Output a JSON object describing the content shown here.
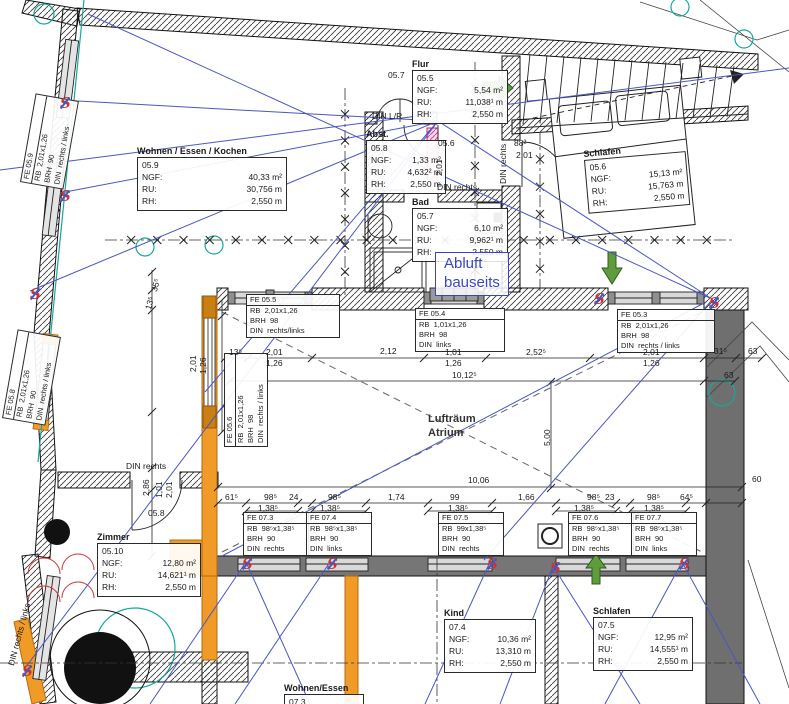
{
  "labels": {
    "ngf": "NGF:",
    "ru": "RU:",
    "rh": "RH:"
  },
  "rooms": [
    {
      "name": "Wohnen / Essen / Kochen",
      "id": "05.9",
      "ngf": "40,33 m²",
      "ru": "30,756 m",
      "rh": "2,550 m",
      "x": 137,
      "y": 146,
      "w": 140,
      "rot": 0
    },
    {
      "name": "Flur",
      "id": "05.5",
      "ngf": "5,54 m²",
      "ru": "11,038¹ m",
      "rh": "2,550 m",
      "x": 412,
      "y": 59,
      "w": 86,
      "rot": 0
    },
    {
      "name": "Abst.",
      "id": "05.8",
      "ngf": "1,33 m²",
      "ru": "4,632² m",
      "rh": "2,550 m",
      "x": 366,
      "y": 129,
      "w": 70,
      "rot": 0
    },
    {
      "name": "Bad",
      "id": "05.7",
      "ngf": "6,10 m²",
      "ru": "9,962¹ m",
      "rh": "2,550 m",
      "x": 412,
      "y": 197,
      "w": 86,
      "rot": 0
    },
    {
      "name": "Schlafen",
      "id": "05.6",
      "ngf": "15,13 m²",
      "ru": "15,763 m",
      "rh": "2,550 m",
      "x": 583,
      "y": 149,
      "w": 92,
      "rot": -5
    },
    {
      "name": "Zimmer",
      "id": "05.10",
      "ngf": "12,80 m²",
      "ru": "14,621¹ m",
      "rh": "2,550 m",
      "x": 97,
      "y": 532,
      "w": 94,
      "rot": 0
    },
    {
      "name": "Kind",
      "id": "07.4",
      "ngf": "10,36 m²",
      "ru": "13,310 m",
      "rh": "2,550 m",
      "x": 444,
      "y": 608,
      "w": 82,
      "rot": 0
    },
    {
      "name": "Schlafen",
      "id": "07.5",
      "ngf": "12,95 m²",
      "ru": "14,555¹ m",
      "rh": "2,550 m",
      "x": 593,
      "y": 606,
      "w": 90,
      "rot": 0
    },
    {
      "name": "Wohnen/Essen",
      "id": "07.3",
      "ngf": "",
      "ru": "",
      "rh": "",
      "x": 284,
      "y": 683,
      "w": 70,
      "rot": 0
    }
  ],
  "fe_labels": [
    {
      "lines": [
        "FE 05.9",
        "RB  2,01x1,26",
        "BRH  90",
        "DIN  rechts / links"
      ],
      "x": 20,
      "y": 182,
      "rot": -80,
      "w": 88
    },
    {
      "lines": [
        "FE 05.8",
        "RB  2,01x1,26",
        "BRH  90",
        "DIN  rechts / links"
      ],
      "x": 2,
      "y": 418,
      "rot": -80,
      "w": 88
    },
    {
      "lines": [
        "FE 05.5",
        "RB  2,01x1,26",
        "BRH  98",
        "DIN  rechts/links"
      ],
      "x": 246,
      "y": 294,
      "rot": 0,
      "w": 92
    },
    {
      "lines": [
        "FE 05.4",
        "RB  1,01x1,26",
        "BRH  98",
        "DIN  links"
      ],
      "x": 415,
      "y": 308,
      "rot": 0,
      "w": 88
    },
    {
      "lines": [
        "FE 05.3",
        "RB  2,01x1,26",
        "BRH  98",
        "DIN  rechts / links"
      ],
      "x": 617,
      "y": 309,
      "rot": 0,
      "w": 96
    },
    {
      "lines": [
        "FE 05.6",
        "RB  2,01x1,26",
        "BRH  98",
        "DIN  rechts / links"
      ],
      "x": 224,
      "y": 447,
      "rot": -90,
      "w": 92
    },
    {
      "lines": [
        "FE 07.3",
        "RB  98⁵x1,38⁵",
        "BRH  90",
        "DIN  rechts"
      ],
      "x": 243,
      "y": 512,
      "rot": 0,
      "w": 64
    },
    {
      "lines": [
        "FE 07.4",
        "RB  98⁵x1,38⁵",
        "BRH  90",
        "DIN  links"
      ],
      "x": 306,
      "y": 512,
      "rot": 0,
      "w": 64
    },
    {
      "lines": [
        "FE 07.5",
        "RB  99x1,38⁵",
        "BRH  90",
        "DIN  rechts"
      ],
      "x": 438,
      "y": 512,
      "rot": 0,
      "w": 64
    },
    {
      "lines": [
        "FE 07.6",
        "RB  98⁵x1,38⁵",
        "BRH  90",
        "DIN  rechts"
      ],
      "x": 568,
      "y": 512,
      "rot": 0,
      "w": 64
    },
    {
      "lines": [
        "FE 07.7",
        "RB  98⁵x1,38⁵",
        "BRH  90",
        "DIN  links"
      ],
      "x": 631,
      "y": 512,
      "rot": 0,
      "w": 64
    }
  ],
  "dim_texts": [
    {
      "t": "05.7",
      "x": 388,
      "y": 70
    },
    {
      "t": "DIN L/R",
      "x": 372,
      "y": 111
    },
    {
      "t": "05.6",
      "x": 438,
      "y": 138
    },
    {
      "t": "2,01",
      "x": 434,
      "y": 176,
      "rot": -90
    },
    {
      "t": "DIN rechts",
      "x": 437,
      "y": 182
    },
    {
      "t": "DIN rechts",
      "x": 498,
      "y": 184,
      "rot": -90
    },
    {
      "t": "88²",
      "x": 514,
      "y": 138
    },
    {
      "t": "2,01",
      "x": 516,
      "y": 150
    },
    {
      "t": "13⁵",
      "x": 229,
      "y": 347
    },
    {
      "t": "2,01",
      "x": 266,
      "y": 347
    },
    {
      "t": "1,26",
      "x": 266,
      "y": 358
    },
    {
      "t": "2,12",
      "x": 380,
      "y": 346
    },
    {
      "t": "1,01",
      "x": 445,
      "y": 347
    },
    {
      "t": "1,26",
      "x": 445,
      "y": 358
    },
    {
      "t": "2,52⁵",
      "x": 526,
      "y": 347
    },
    {
      "t": "2,01",
      "x": 643,
      "y": 347
    },
    {
      "t": "1,26",
      "x": 643,
      "y": 358
    },
    {
      "t": "31⁵",
      "x": 714,
      "y": 346
    },
    {
      "t": "63",
      "x": 748,
      "y": 346
    },
    {
      "t": "10,12⁵",
      "x": 452,
      "y": 370
    },
    {
      "t": "63",
      "x": 724,
      "y": 370
    },
    {
      "t": "60",
      "x": 752,
      "y": 474
    },
    {
      "t": "10,06",
      "x": 468,
      "y": 475
    },
    {
      "t": "5,00",
      "x": 542,
      "y": 446,
      "rot": -90
    },
    {
      "t": "35⁵",
      "x": 149,
      "y": 290,
      "rot": -75
    },
    {
      "t": "13⁵",
      "x": 143,
      "y": 308,
      "rot": -75
    },
    {
      "t": "2,01",
      "x": 188,
      "y": 372,
      "rot": -90
    },
    {
      "t": "1,26",
      "x": 198,
      "y": 374,
      "rot": -90
    },
    {
      "t": "DIN rechts",
      "x": 126,
      "y": 461
    },
    {
      "t": "2,86",
      "x": 141,
      "y": 496,
      "rot": -90
    },
    {
      "t": "1,01",
      "x": 154,
      "y": 498,
      "rot": -90
    },
    {
      "t": "2,01",
      "x": 164,
      "y": 498,
      "rot": -90
    },
    {
      "t": "05.8",
      "x": 148,
      "y": 508
    },
    {
      "t": "61⁵",
      "x": 225,
      "y": 492
    },
    {
      "t": "98⁵",
      "x": 264,
      "y": 492
    },
    {
      "t": "24",
      "x": 289,
      "y": 492
    },
    {
      "t": "98⁵",
      "x": 328,
      "y": 492
    },
    {
      "t": "1,74",
      "x": 388,
      "y": 492
    },
    {
      "t": "99",
      "x": 450,
      "y": 492
    },
    {
      "t": "1,66",
      "x": 518,
      "y": 492
    },
    {
      "t": "98⁵",
      "x": 587,
      "y": 492
    },
    {
      "t": "23",
      "x": 605,
      "y": 492
    },
    {
      "t": "98⁵",
      "x": 647,
      "y": 492
    },
    {
      "t": "64⁵",
      "x": 680,
      "y": 492
    },
    {
      "t": "1,38⁵",
      "x": 258,
      "y": 503
    },
    {
      "t": "1,38⁵",
      "x": 320,
      "y": 503
    },
    {
      "t": "1,38⁵",
      "x": 448,
      "y": 503
    },
    {
      "t": "1,38⁵",
      "x": 574,
      "y": 503
    },
    {
      "t": "1,38⁵",
      "x": 644,
      "y": 503
    },
    {
      "t": "DIN rechts / links",
      "x": 6,
      "y": 664,
      "rot": -75
    }
  ],
  "notes": {
    "abluft_line1": "Abluft",
    "abluft_line2": "bauseits",
    "atrium_line1": "Lufträum",
    "atrium_line2": "Atrium"
  },
  "markers": {
    "glyph": "S",
    "positions": [
      [
        60,
        96
      ],
      [
        60,
        189
      ],
      [
        30,
        287
      ],
      [
        594,
        292
      ],
      [
        709,
        296
      ],
      [
        242,
        557
      ],
      [
        327,
        557
      ],
      [
        487,
        557
      ],
      [
        550,
        561
      ],
      [
        679,
        557
      ],
      [
        22,
        664
      ]
    ]
  },
  "colors": {
    "blue_line": "#4956c4",
    "note_blue": "#3a46c0",
    "orange": "#f09a28",
    "pink": "#d6488f",
    "green_arrow": "#5f9c3c",
    "teal": "#18a79a",
    "red_marker": "#cc3333",
    "wall_gray": "#767676",
    "wall_dark": "#6f6f6f"
  }
}
